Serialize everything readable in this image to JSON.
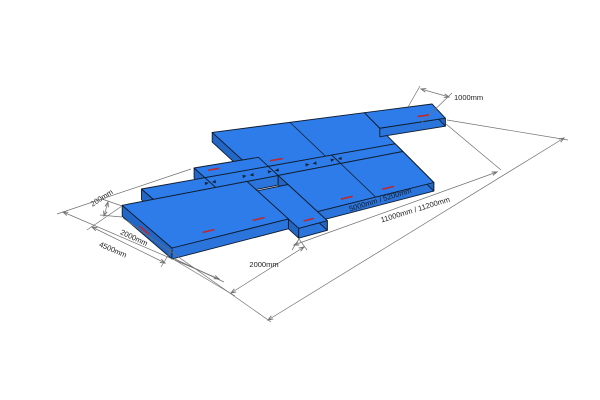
{
  "colors": {
    "background": "#ffffff",
    "platform_top": "#2d7ce9",
    "platform_front": "#2a74db",
    "platform_end": "#2367c6",
    "outline": "#101c2e",
    "seam": "#15253d",
    "coupler": "#14233c",
    "dimension_line": "#707070",
    "label_text": "#1c1c1c",
    "accent_mark": "#c0272d"
  },
  "dimensions": {
    "height": {
      "label": "200mm"
    },
    "platform_width": {
      "label": "2000mm"
    },
    "overall_width": {
      "label": "4500mm"
    },
    "module_length": {
      "label": "2000mm"
    },
    "inner_length": {
      "label": "5000mm / 5200mm"
    },
    "overall_length": {
      "label": "11000mm / 11200mm"
    },
    "end_width": {
      "label": "1000mm"
    }
  }
}
